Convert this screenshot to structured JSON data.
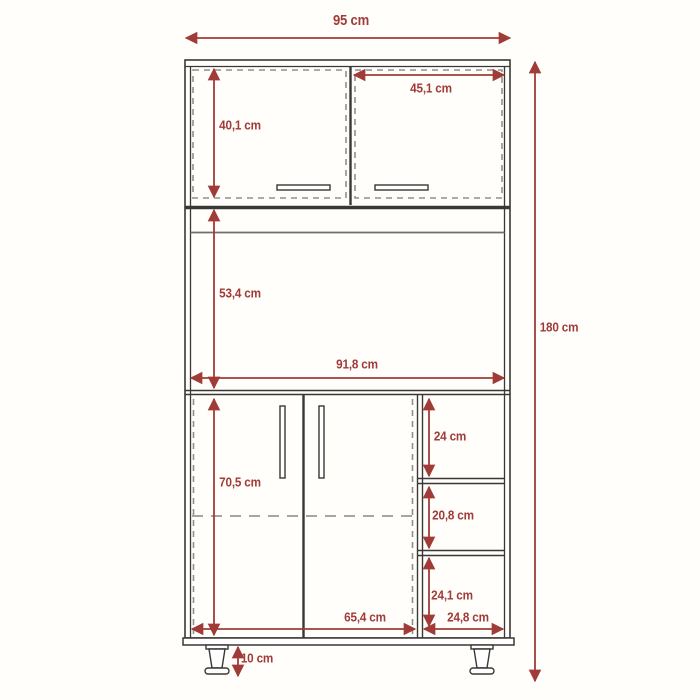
{
  "diagram": {
    "unit": "cm",
    "labels": {
      "overall_width": "95 cm",
      "overall_height": "180 cm",
      "upper_door_height": "40,1 cm",
      "upper_right_door_width": "45,1 cm",
      "open_section_height": "53,4 cm",
      "interior_width": "91,8 cm",
      "lower_door_height": "70,5 cm",
      "top_shelf_height": "24 cm",
      "middle_shelf_height": "20,8 cm",
      "bottom_shelf_height": "24,1 cm",
      "lower_doors_width": "65,4 cm",
      "shelf_column_width": "24,8 cm",
      "leg_height": "10 cm"
    },
    "colors": {
      "dimension_red": "#a03b38",
      "outline_dark": "#3a3836",
      "dashed_gray": "#8f8f8f",
      "background": "#fffefa"
    }
  }
}
